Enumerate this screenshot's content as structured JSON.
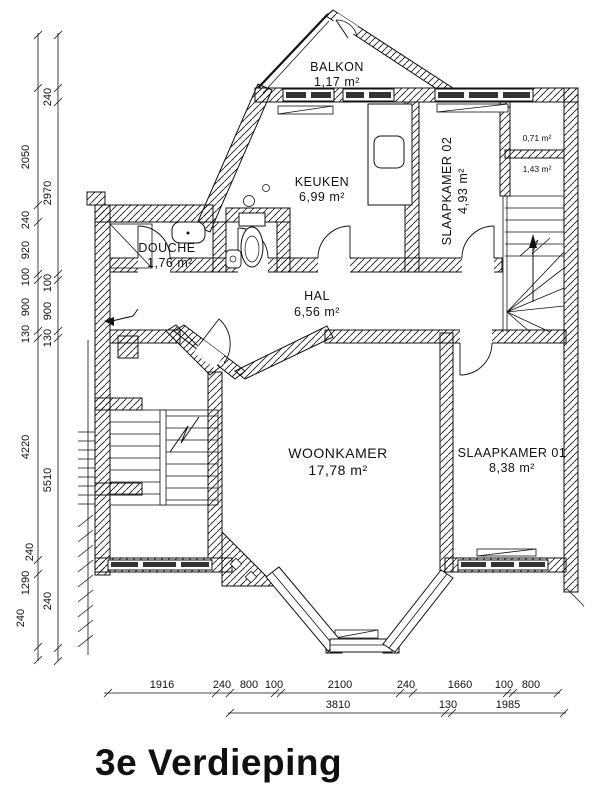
{
  "title": "3e Verdieping",
  "rooms": {
    "balkon": {
      "name": "BALKON",
      "area": "1,17 m²"
    },
    "keuken": {
      "name": "KEUKEN",
      "area": "6,99 m²"
    },
    "slaapkamer02": {
      "name": "SLAAPKAMER 02",
      "area": "4,93 m²"
    },
    "kast_boven": {
      "area": "0,71 m²"
    },
    "kast_onder": {
      "area": "1,43 m²"
    },
    "douche": {
      "name": "DOUCHE",
      "area": "1,76 m²"
    },
    "hal": {
      "name": "HAL",
      "area": "6,56 m²"
    },
    "woonkamer": {
      "name": "WOONKAMER",
      "area": "17,78 m²"
    },
    "slaapkamer01": {
      "name": "SLAAPKAMER 01",
      "area": "8,38 m²"
    }
  },
  "dimensions": {
    "left_outer": [
      "2050",
      "240",
      "920",
      "100",
      "900",
      "130",
      "4220",
      "240",
      "1290",
      "240"
    ],
    "left_inner": [
      "240",
      "2970",
      "100",
      "900",
      "130",
      "5510",
      "240"
    ],
    "bottom_row1": [
      "1916",
      "240",
      "800",
      "100",
      "2100",
      "240",
      "1660",
      "100",
      "800"
    ],
    "bottom_row2": [
      "3810",
      "130",
      "1985"
    ]
  }
}
